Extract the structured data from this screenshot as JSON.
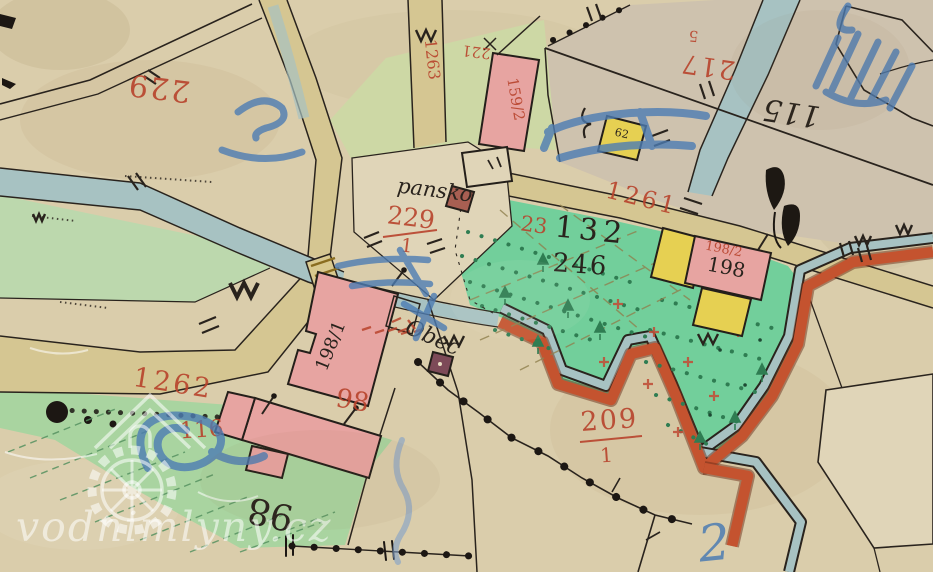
{
  "map": {
    "type": "historic-cadastral-map-scan",
    "watermark": {
      "text": "vodnimlyny.cz"
    },
    "labels": {
      "parcel_229": "229",
      "parcel_221": "221",
      "parcel_217": "217",
      "small_5": "5",
      "house_115": "115",
      "house_159_2": "159/2",
      "road_1263": "1263",
      "road_1261": "1261",
      "road_1262": "1262",
      "name_pansko": "pansko",
      "parcel_229_1_num": "229",
      "parcel_229_1_den": "1",
      "parcel_132": "132",
      "parcel_23": "23",
      "parcel_246": "246",
      "house_62": "62",
      "house_198_2": "198/2",
      "house_198": "198",
      "house_198_1": "198/1",
      "name_obec": "Obec",
      "parcel_116": "116",
      "house_98": "98",
      "parcel_98": "98",
      "parcel_209_num": "209",
      "parcel_209_den": "1",
      "note_2": "2"
    }
  },
  "palette": {
    "paper": "#dacdab",
    "paperLight": "#e0d5b8",
    "grayParcel": "#cec2ae",
    "paleGreen": "#cdd8a5",
    "meadow": "#bcd8ad",
    "meadow2": "#a9d4a0",
    "brightGreen": "#72cf9b",
    "road": "#d5c692",
    "stream": "#a7c2c2",
    "pinkBuilding": "#e7a4a1",
    "yellowBuilding": "#e6d052",
    "redBand": "#c4532f",
    "redInk": "#b8432c",
    "blueInk": "#4d7cb3",
    "blackInk": "#29231d",
    "watermark": "rgba(255,255,255,0.55)"
  }
}
